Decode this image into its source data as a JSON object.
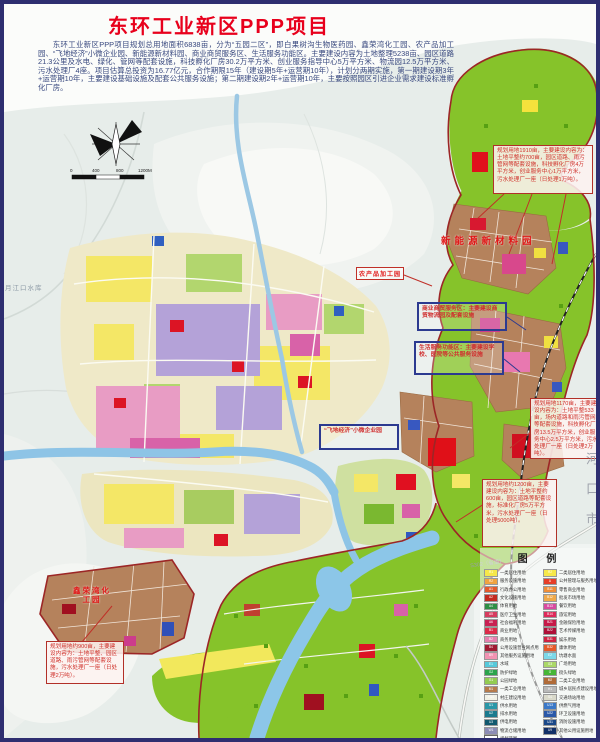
{
  "page": {
    "title": "东环工业新区PPP项目",
    "intro": "东环工业新区PPP项目规划总用地面积6838亩，分为“五园二区”，即白果树沟生物医药园、鑫荣湾化工园、农产品加工园、“飞地经济”小微企业园、新能源新材料园、商业商贸服务区、生活服务功能区。主要建设内容为土地整理5238亩、园区道路21.3公里及水电、绿化、管网等配套设施，科技孵化厂房30.2万平方米、创业服务指导中心5万平方米、物流园12.5万平方米、污水处理厂4座。项目估算总投资为16.77亿元，合作期限15年（建设期5年+运营期10年），计划分两期实施，第一期建设期3年+运营期10年，主要建设基础设施及配套公共服务设施；第二期建设期2年+运营期10年，主要按照园区引进企业需求建设标准孵化厂房。"
  },
  "colors": {
    "title_red": "#e8001c",
    "callout_red": "#cf2f28",
    "annotation_blue": "#2c3a90",
    "boundary_red": "#9c2626",
    "green_zone": "#86c32a",
    "industrial_brown": "#b5825c",
    "water_blue": "#8cc6e8"
  },
  "map": {
    "zone_labels": {
      "new_energy": "新能源新材料园",
      "processing": "农产品加工园",
      "chemical": "鑫荣湾化工园"
    },
    "notes": {
      "reservoir": "月江口水库",
      "road": "S302（省道）",
      "city_vertical": "河口市"
    },
    "scalebar_ticks": [
      "0",
      "400",
      "800",
      "1200M"
    ],
    "callouts": [
      {
        "text": "规划用地1910亩，主要建设内容为：土地平整约700亩，园区道路、雨污管网等配套设施，科技孵化厂房4万平方米，创业服务中心1万平方米，污水处理厂一座（日处理1万吨）。"
      },
      {
        "text": "规划用地1170亩，主要建设内容为：土地平整533亩，场内道路和雨污管网等配套设施，科技孵化厂房13.5万平方米，创业服务中心2.5万平方米，污水处理厂一座（日处理2万吨）。"
      },
      {
        "text": "规划用地约1200亩，主要建设内容为：土地平整约600亩，园区道路等配套设施，标准化厂房5万平方米，污水处理厂一座（日处理5000吨）。"
      },
      {
        "text": "规划用地约900亩，主要建设内容为：土地平整、园区道路、雨污管网等配套设施，污水处理厂一座（日处理2万吨）。"
      }
    ],
    "annotations": [
      {
        "text": "商业商贸服务区：主要建设商贸物流园及配套设施"
      },
      {
        "text": "生活服务功能区：主要建设学校、医院等公共服务设施"
      },
      {
        "text": "“飞地经济”小微企业园"
      }
    ]
  },
  "legend": {
    "title": "图 例",
    "columns": [
      [
        {
          "color": "#f6e84a",
          "code": "R1",
          "label": "一类居住用地"
        },
        {
          "color": "#f0a440",
          "code": "R2",
          "label": "服务设施用地"
        },
        {
          "color": "#e45a2c",
          "code": "A1",
          "label": "行政办公用地"
        },
        {
          "color": "#c42a20",
          "code": "A2",
          "label": "文化设施用地"
        },
        {
          "color": "#2f8f46",
          "code": "A4",
          "label": "体育用地"
        },
        {
          "color": "#d63c5e",
          "code": "A5",
          "label": "医疗卫生用地"
        },
        {
          "color": "#c82052",
          "code": "A6",
          "label": "社会福利用地"
        },
        {
          "color": "#dc2a48",
          "code": "B1",
          "label": "商业用地"
        },
        {
          "color": "#e67fae",
          "code": "B2",
          "label": "商务用地"
        },
        {
          "color": "#a01a32",
          "code": "B4",
          "label": "公用设施营业网点用地"
        },
        {
          "color": "#f193b2",
          "code": "B9",
          "label": "其他服务设施用地"
        },
        {
          "color": "#57c9da",
          "code": "E1",
          "label": "水域"
        },
        {
          "color": "#2ba44c",
          "code": "G2",
          "label": "防护绿地"
        },
        {
          "color": "#93cc52",
          "code": "G1",
          "label": "公园绿地"
        },
        {
          "color": "#b67b4c",
          "code": "M1",
          "label": "一类工业用地"
        },
        {
          "color": "#f1f1e6",
          "code": "H14",
          "label": "村庄建设用地"
        },
        {
          "color": "#2a97a8",
          "code": "U1",
          "label": "供水用地"
        },
        {
          "color": "#1b7a8e",
          "code": "U2",
          "label": "排水用地"
        },
        {
          "color": "#12596e",
          "code": "U3",
          "label": "供电用地"
        },
        {
          "color": "#8d8db6",
          "code": "W1",
          "label": "物流仓储用地"
        },
        {
          "color": "#ffffff",
          "code": "",
          "label": "规划范围",
          "outline": true
        }
      ],
      [
        {
          "color": "#f6e84a",
          "code": "R2",
          "label": "二类居住用地"
        },
        {
          "color": "#e63e28",
          "code": "A",
          "label": "公共管理与服务用地"
        },
        {
          "color": "#ef8e38",
          "code": "B11",
          "label": "零售商业用地"
        },
        {
          "color": "#efa94a",
          "code": "B12",
          "label": "批发市场用地"
        },
        {
          "color": "#d84aa0",
          "code": "B13",
          "label": "餐饮用地"
        },
        {
          "color": "#de2a5a",
          "code": "B14",
          "label": "旅馆用地"
        },
        {
          "color": "#c61a48",
          "code": "B21",
          "label": "金融保险用地"
        },
        {
          "color": "#ae1038",
          "code": "B22",
          "label": "艺术传媒用地"
        },
        {
          "color": "#d02242",
          "code": "B31",
          "label": "娱乐用地"
        },
        {
          "color": "#e65a2a",
          "code": "B32",
          "label": "康体用地"
        },
        {
          "color": "#7bd8e8",
          "code": "E2",
          "label": "坑塘水面"
        },
        {
          "color": "#aad768",
          "code": "G3",
          "label": "广场用地"
        },
        {
          "color": "#46b637",
          "code": "G",
          "label": "街头绿地"
        },
        {
          "color": "#b06b38",
          "code": "M2",
          "label": "二类工业用地"
        },
        {
          "color": "#b9b9b9",
          "code": "H1",
          "label": "城乡居民点建设用地"
        },
        {
          "color": "#d9d9ca",
          "code": "S4",
          "label": "交通场站用地"
        },
        {
          "color": "#3a78c8",
          "code": "U13",
          "label": "供燃气用地"
        },
        {
          "color": "#2a58a8",
          "code": "U22",
          "label": "环卫设施用地"
        },
        {
          "color": "#1a4888",
          "code": "U31",
          "label": "消防设施用地"
        },
        {
          "color": "#123068",
          "code": "U9",
          "label": "其他公用设施用地"
        }
      ]
    ]
  }
}
